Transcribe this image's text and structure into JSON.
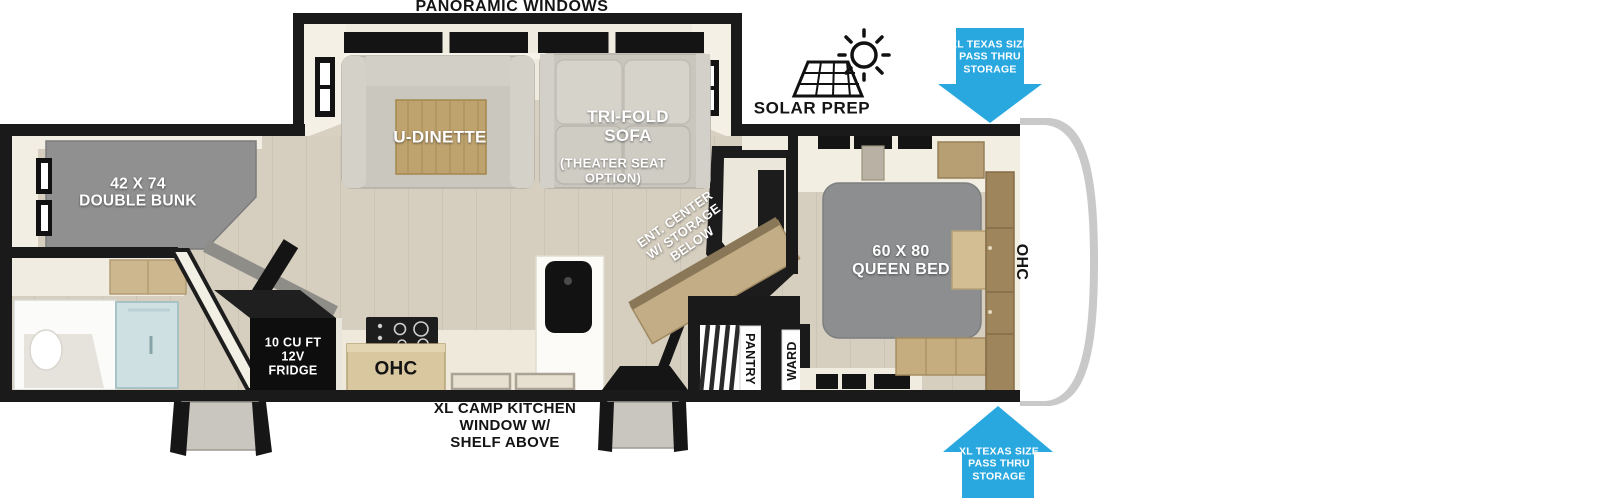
{
  "title": "Travel trailer floor plan",
  "colors": {
    "arrow_blue": "#29a8e0",
    "wall_black": "#1a1a1a",
    "floor_tan": "#d6cfc0",
    "furniture_gray": "#8f9092",
    "wood_tan": "#c3ad86",
    "shower_glass": "#cfe0e3",
    "label_white": "#ffffff"
  },
  "callouts": {
    "panoramic_windows": "PANORAMIC WINDOWS",
    "solar_prep": "SOLAR PREP",
    "pass_thru_top": "XL TEXAS SIZE\nPASS THRU\nSTORAGE",
    "pass_thru_bottom": "XL TEXAS SIZE\nPASS THRU\nSTORAGE",
    "camp_kitchen": "XL CAMP KITCHEN\nWINDOW W/\nSHELF ABOVE"
  },
  "rooms": {
    "dinette": "U-DINETTE",
    "sofa": "TRI-FOLD\nSOFA",
    "sofa_option": "(THEATER SEAT\nOPTION)",
    "bunk": "42 X 74\nDOUBLE BUNK",
    "queen_bed": "60 X 80\nQUEEN BED",
    "ent_center": "ENT. CENTER\nW/ STORAGE\nBELOW",
    "fridge": "10 CU FT\n12V\nFRIDGE",
    "ohc_kitchen": "OHC",
    "ohc_bedroom": "OHC",
    "pantry": "PANTRY",
    "ward": "WARD"
  }
}
